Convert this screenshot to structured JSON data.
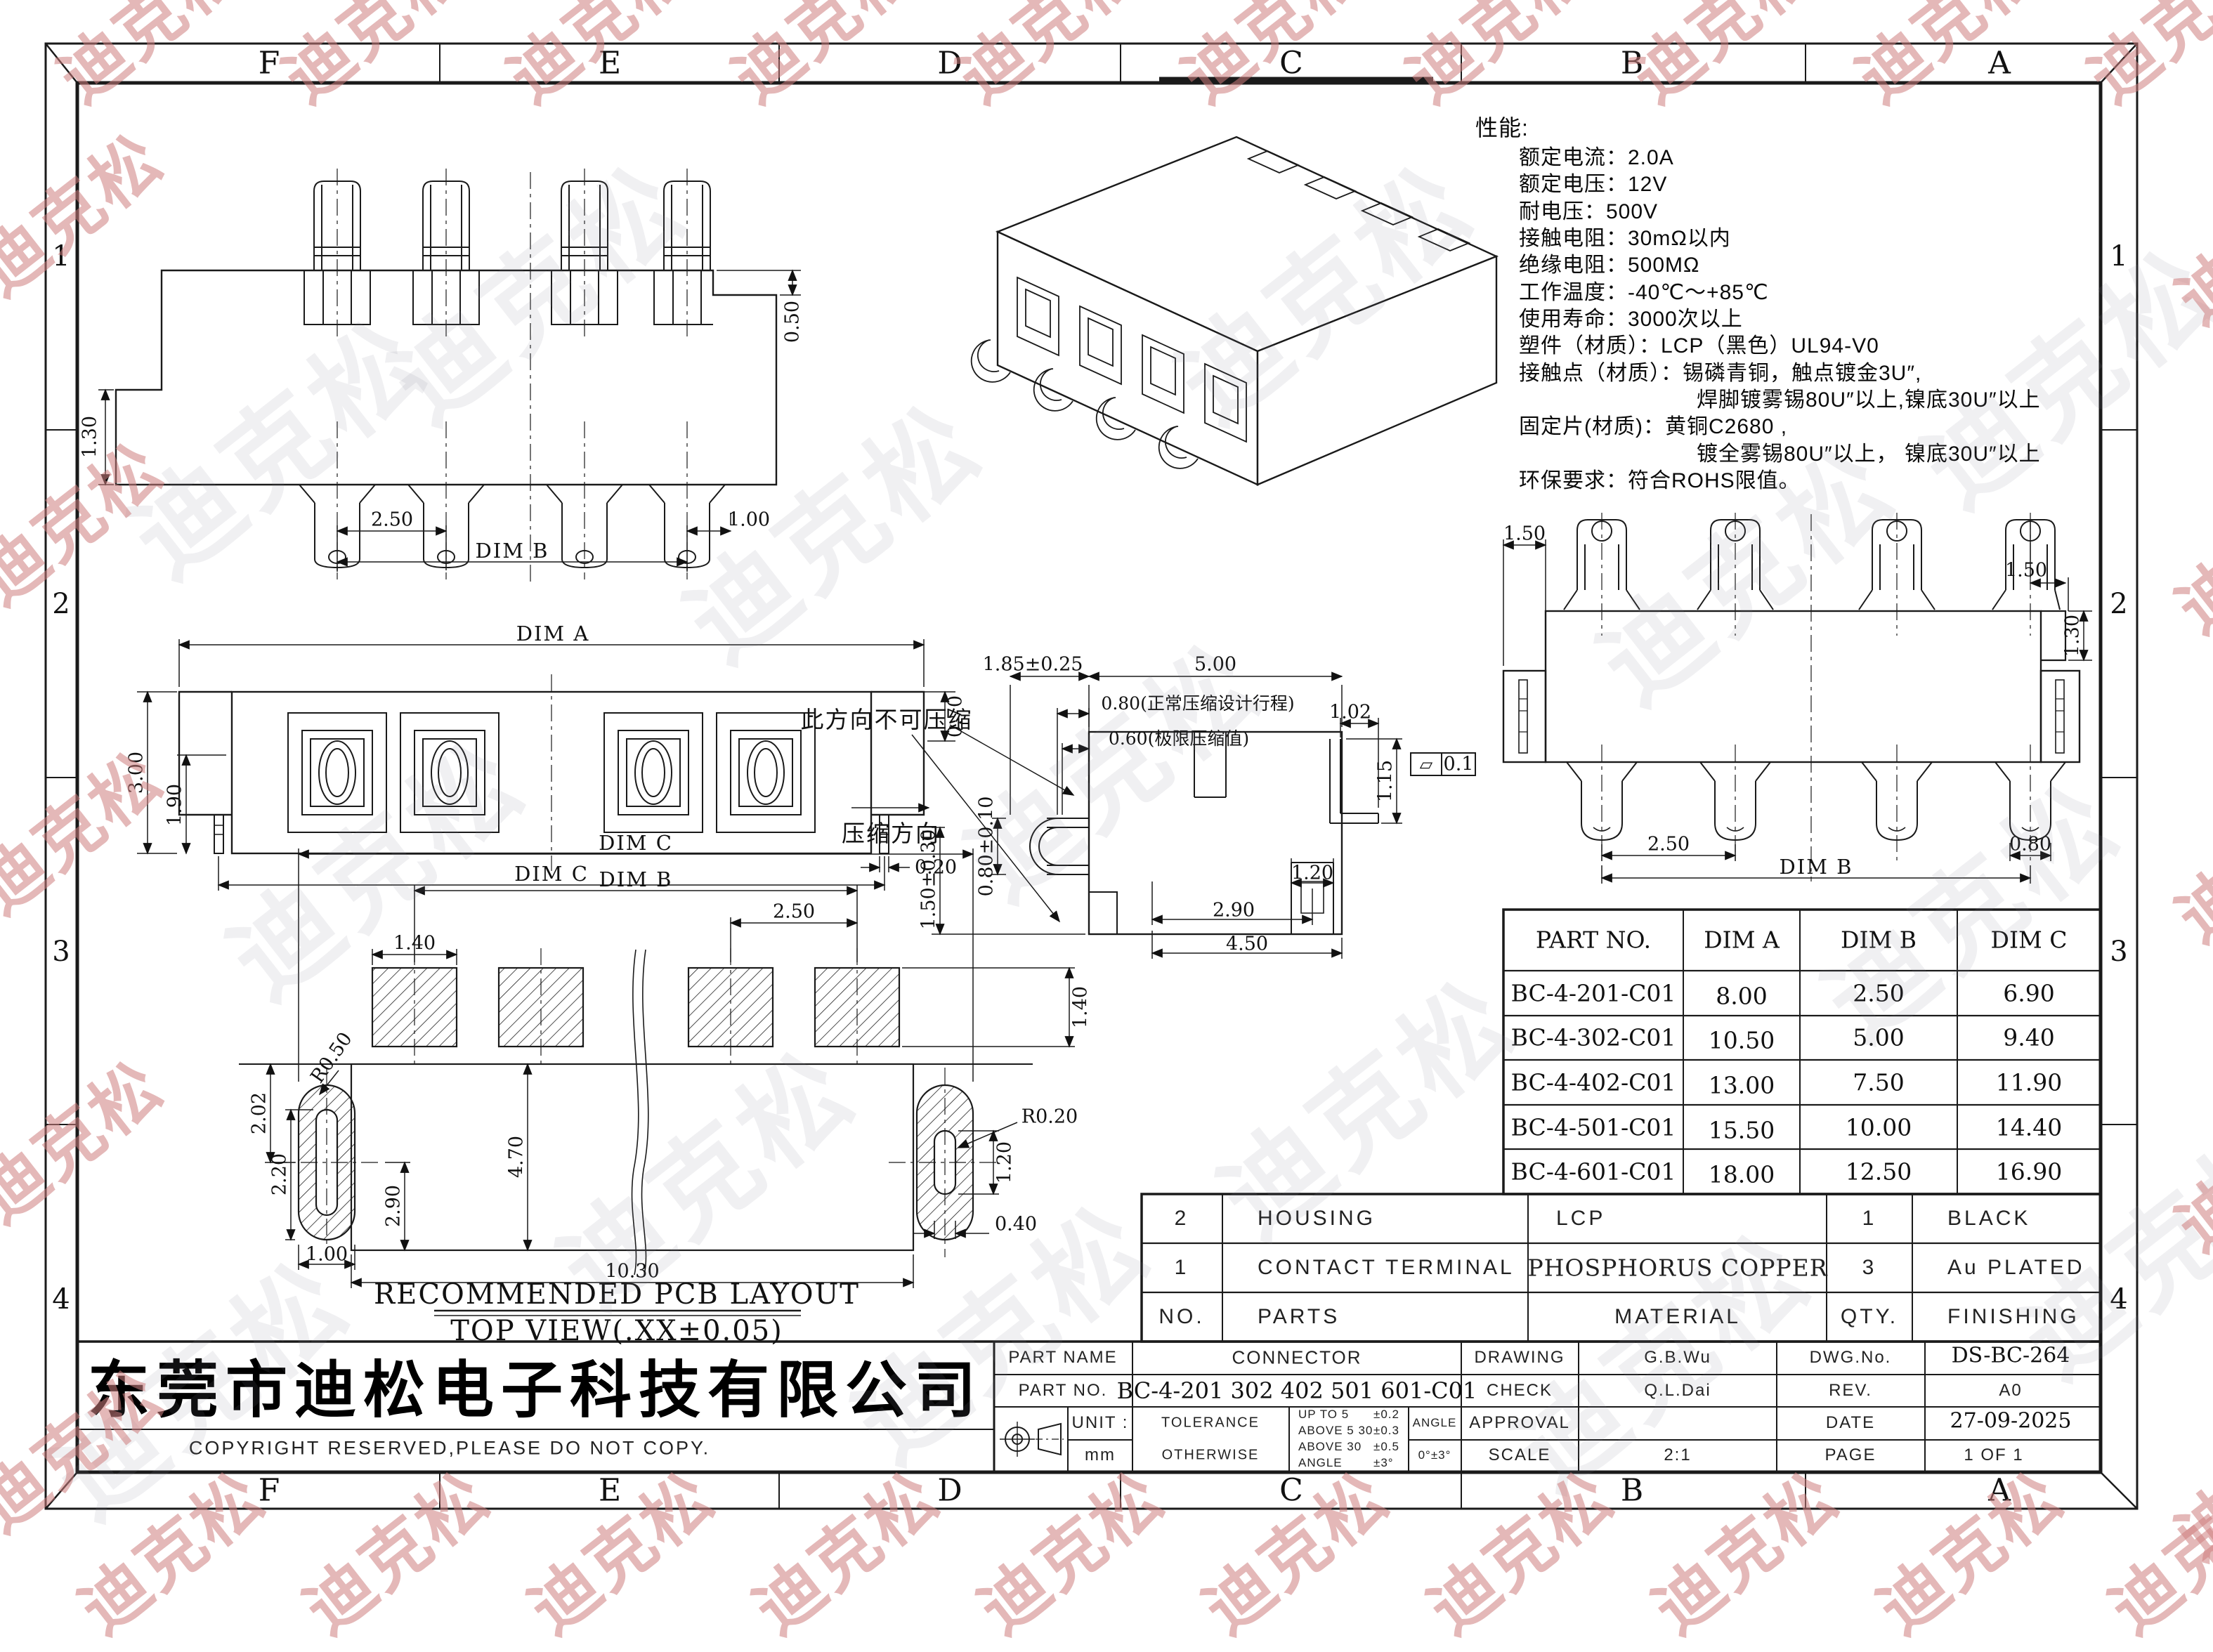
{
  "watermark": {
    "text": "迪克松"
  },
  "frame": {
    "top_letters": [
      "F",
      "E",
      "D",
      "C",
      "B",
      "A"
    ],
    "bottom_letters": [
      "F",
      "E",
      "D",
      "C",
      "B",
      "A"
    ],
    "left_numbers": [
      "1",
      "2",
      "3",
      "4"
    ],
    "right_numbers": [
      "1",
      "2",
      "3",
      "4"
    ]
  },
  "specs": {
    "title": "性能:",
    "lines": [
      "额定电流：2.0A",
      "额定电压：12V",
      "耐电压：500V",
      "接触电阻：30mΩ以内",
      "绝缘电阻：500MΩ",
      "工作温度：-40℃～+85℃",
      "使用寿命：3000次以上",
      "塑件（材质）：LCP（黑色）UL94-V0",
      "接触点（材质）：锡磷青铜，触点镀金3U″,",
      "焊脚镀雾锡80U″以上,镍底30U″以上",
      "固定片(材质)：黄铜C2680 ,",
      "镀全雾锡80U″以上， 镍底30U″以上",
      "环保要求：符合ROHS限值。"
    ]
  },
  "dims": {
    "v1_050": "0.50",
    "v1_130": "1.30",
    "v1_250": "2.50",
    "v1_100": "1.00",
    "v1_dimb": "DIM B",
    "v2_dima": "DIM A",
    "v2_300": "3.00",
    "v2_190": "1.90",
    "v2_070": "0.70",
    "v2_020": "0.20",
    "v2_dimc": "DIM C",
    "v3_dimc": "DIM C",
    "v3_dimb": "DIM B",
    "v3_250": "2.50",
    "v3_140l": "1.40",
    "v3_140r": "1.40",
    "v3_r050": "R0.50",
    "v3_202": "2.02",
    "v3_220": "2.20",
    "v3_100": "1.00",
    "v3_290": "2.90",
    "v3_470": "4.70",
    "v3_1030": "10.30",
    "v3_r020": "R0.20",
    "v3_120": "1.20",
    "v3_040": "0.40",
    "v4_185": "1.85±0.25",
    "v4_500": "5.00",
    "v4_080n": "0.80(正常压缩设计行程)",
    "v4_060": "0.60(极限压缩值)",
    "v4_102": "1.02",
    "v4_080": "0.80±0.10",
    "v4_115": "1.15",
    "v4_flat_sym": "▱",
    "v4_01": "0.1",
    "v4_120": "1.20",
    "v4_290": "2.90",
    "v4_450": "4.50",
    "v4_150": "1.50±0.30",
    "v4_nocomp": "此方向不可压缩",
    "v4_dir": "压缩方向",
    "v6_150l": "1.50",
    "v6_150r": "1.50",
    "v6_130": "1.30",
    "v6_080": "0.80",
    "v6_250": "2.50",
    "v6_dimb": "DIM B"
  },
  "pcb_titles": {
    "line1": "RECOMMENDED PCB LAYOUT",
    "line2": "TOP VIEW(.XX±0.05)"
  },
  "parts_table": {
    "headers": [
      "PART NO.",
      "DIM A",
      "DIM B",
      "DIM C"
    ],
    "rows": [
      [
        "BC-4-201-C01",
        "8.00",
        "2.50",
        "6.90"
      ],
      [
        "BC-4-302-C01",
        "10.50",
        "5.00",
        "9.40"
      ],
      [
        "BC-4-402-C01",
        "13.00",
        "7.50",
        "11.90"
      ],
      [
        "BC-4-501-C01",
        "15.50",
        "10.00",
        "14.40"
      ],
      [
        "BC-4-601-C01",
        "18.00",
        "12.50",
        "16.90"
      ]
    ]
  },
  "bom": {
    "rows": [
      [
        "2",
        "HOUSING",
        "LCP",
        "1",
        "BLACK"
      ],
      [
        "1",
        "CONTACT TERMINAL",
        "PHOSPHORUS COPPER",
        "3",
        "Au PLATED"
      ],
      [
        "NO.",
        "PARTS",
        "MATERIAL",
        "QTY.",
        "FINISHING"
      ]
    ]
  },
  "title_block": {
    "part_name_label": "PART NAME",
    "part_name": "CONNECTOR",
    "part_no_label": "PART NO.",
    "part_no": "BC-4-201 302 402 501 601-C01",
    "drawing_label": "DRAWING",
    "drawing": "G.B.Wu",
    "check_label": "CHECK",
    "check": "Q.L.Dai",
    "approval_label": "APPROVAL",
    "approval": "",
    "scale_label": "SCALE",
    "scale": "2:1",
    "dwg_no_label": "DWG.No.",
    "dwg_no": "DS-BC-264",
    "rev_label": "REV.",
    "rev": "A0",
    "date_label": "DATE",
    "date": "27-09-2025",
    "page_label": "PAGE",
    "page": "1 OF 1",
    "unit_label": "UNIT :",
    "unit": "mm",
    "tolerance_label_1": "TOLERANCE",
    "tolerance_label_2": "OTHERWISE",
    "tol_r1_l": "UP TO 5",
    "tol_r1_v": "±0.2",
    "tol_r2_l": "ABOVE 5  30",
    "tol_r2_v": "±0.3",
    "tol_r3_l": "ABOVE 30",
    "tol_r3_v": "±0.5",
    "tol_r4_l": "ANGLE",
    "tol_r4_v": "±3°",
    "angle_label": "ANGLE",
    "angle_value": "0°±3°"
  },
  "company": {
    "name": "东莞市迪松电子科技有限公司",
    "copyright": "COPYRIGHT RESERVED,PLEASE DO NOT COPY."
  }
}
